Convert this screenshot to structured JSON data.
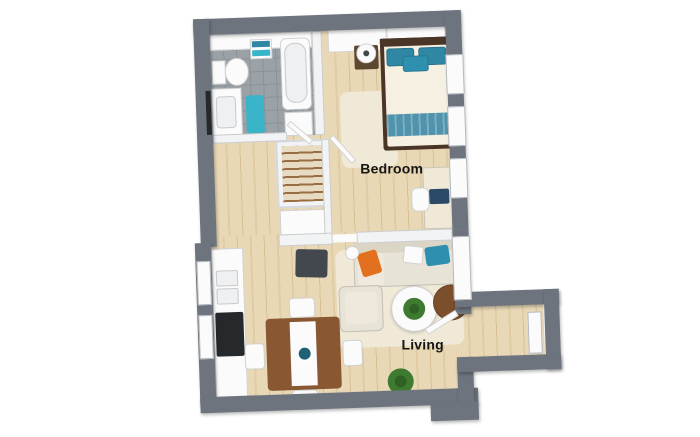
{
  "plan": {
    "labels": {
      "bedroom": "Bedroom",
      "living": "Living"
    },
    "colors": {
      "wall": "#6d747d",
      "innerWall": "#f2f3f4",
      "wood": "#e9d8b6",
      "woodStreak": "#dfcba4",
      "woodDark": "#d6c094",
      "tile": "#9aa2a8",
      "tileLine": "#8b9399",
      "white": "#fbfbfb",
      "cream": "#f0e9d8",
      "sofa": "#e7e3d6",
      "sofaBack": "#dad5c4",
      "sofaSeat": "#eee9dc",
      "teal": "#2f87a3",
      "tealBright": "#3ab4c8",
      "tealSofa": "#2f8fae",
      "tealRunner": "#4f93ac",
      "tealDeep": "#1f6077",
      "orange": "#e2701f",
      "brown": "#8a5733",
      "brownDark": "#7b4e2c",
      "nightstand": "#5e4731",
      "bedFrame": "#4a3527",
      "mattress": "#f5f0e1",
      "charcoal": "#43484e",
      "black": "#26292c",
      "green": "#3e7b30",
      "greenDark": "#2f6124",
      "navy": "#2b4a67",
      "basin": "#eef0f1"
    },
    "defaults": {
      "furnitureBorder": "1px solid rgba(0,0,0,0.16)",
      "windowBorder": "1px solid #b3b9bf",
      "wallShadow": "1px 2px 3px rgba(0,0,0,0.28)"
    }
  },
  "shapes": [
    {
      "n": "floor-bathroom-tile",
      "x": 216,
      "y": 30,
      "w": 102,
      "h": 104,
      "f": "tile"
    },
    {
      "n": "floor-bedroom-wood",
      "x": 328,
      "y": 30,
      "w": 124,
      "h": 202,
      "f": "wood"
    },
    {
      "n": "floor-hallway-wood",
      "x": 216,
      "y": 134,
      "w": 112,
      "h": 98,
      "f": "wood"
    },
    {
      "n": "floor-living-wood",
      "x": 210,
      "y": 232,
      "w": 256,
      "h": 160,
      "f": "wood"
    },
    {
      "n": "floor-vestibule-wood",
      "x": 466,
      "y": 311,
      "w": 74,
      "h": 50,
      "f": "wood"
    },
    {
      "n": "floor-threshold-vestibule",
      "x": 452,
      "y": 317,
      "w": 16,
      "h": 44,
      "f": "wood"
    },
    {
      "n": "bedroom-rug",
      "x": 344,
      "y": 92,
      "w": 56,
      "h": 76,
      "f": "cream",
      "r": 8
    },
    {
      "n": "living-rug",
      "x": 334,
      "y": 250,
      "w": 126,
      "h": 98,
      "f": "cream",
      "r": 8
    },
    {
      "n": "bathroom-wall-tiles",
      "x": 216,
      "y": 30,
      "w": 102,
      "h": 16,
      "f": "white",
      "b": "1px solid #d8dbde"
    },
    {
      "n": "toilet-tank",
      "x": 217,
      "y": 56,
      "w": 14,
      "h": 24,
      "f": "white",
      "b": 1
    },
    {
      "n": "toilet-bowl",
      "x": 230,
      "y": 54,
      "w": 24,
      "h": 28,
      "f": "white",
      "r": "50%",
      "b": 1
    },
    {
      "n": "vanity-counter",
      "x": 216,
      "y": 84,
      "w": 30,
      "h": 50,
      "f": "white",
      "b": 1
    },
    {
      "n": "vanity-basin",
      "x": 220,
      "y": 92,
      "w": 20,
      "h": 32,
      "f": "basin",
      "r": 4,
      "b": 1
    },
    {
      "n": "bathtub",
      "x": 286,
      "y": 36,
      "w": 30,
      "h": 72,
      "f": "white",
      "r": 6,
      "b": 1
    },
    {
      "n": "bathtub-inner",
      "x": 290,
      "y": 41,
      "w": 22,
      "h": 60,
      "f": "basin",
      "r": 10,
      "b": 1
    },
    {
      "n": "towel-shelf",
      "x": 256,
      "y": 36,
      "w": 22,
      "h": 20,
      "f": "white",
      "b": 1
    },
    {
      "n": "towel-teal-top",
      "x": 258,
      "y": 38,
      "w": 18,
      "h": 6,
      "f": "teal"
    },
    {
      "n": "towel-teal-bottom",
      "x": 258,
      "y": 47,
      "w": 18,
      "h": 6,
      "f": "tealBright"
    },
    {
      "n": "bath-mat",
      "x": 250,
      "y": 92,
      "w": 18,
      "h": 38,
      "f": "tealBright",
      "r": 3
    },
    {
      "n": "washer-cabinet",
      "x": 288,
      "y": 110,
      "w": 28,
      "h": 24,
      "f": "white",
      "b": 1
    },
    {
      "n": "wardrobe",
      "x": 334,
      "y": 26,
      "w": 118,
      "h": 26,
      "f": "white",
      "b": 1
    },
    {
      "n": "wardrobe-door-divider",
      "x": 392,
      "y": 27,
      "w": 2,
      "h": 24,
      "f": "#d9dcdf"
    },
    {
      "n": "nightstand",
      "x": 360,
      "y": 46,
      "w": 24,
      "h": 24,
      "f": "nightstand",
      "r": 2
    },
    {
      "n": "nightstand-lamp",
      "x": 362,
      "y": 44,
      "w": 20,
      "h": 20,
      "f": "white",
      "r": "50%",
      "b": 1
    },
    {
      "n": "nightstand-lamp-center",
      "x": 369,
      "y": 51,
      "w": 6,
      "h": 6,
      "f": "charcoal",
      "r": "50%"
    },
    {
      "n": "bed-frame",
      "x": 386,
      "y": 40,
      "w": 72,
      "h": 112,
      "f": "bedFrame",
      "r": 3
    },
    {
      "n": "bed-mattress",
      "x": 390,
      "y": 46,
      "w": 64,
      "h": 102,
      "f": "mattress",
      "r": 2
    },
    {
      "n": "bed-pillow-left",
      "x": 392,
      "y": 50,
      "w": 28,
      "h": 18,
      "f": "teal",
      "r": 3,
      "b": 1
    },
    {
      "n": "bed-pillow-right",
      "x": 424,
      "y": 50,
      "w": 28,
      "h": 18,
      "f": "teal",
      "r": 3,
      "b": 1
    },
    {
      "n": "bed-pillow-accent",
      "x": 408,
      "y": 58,
      "w": 26,
      "h": 16,
      "f": "tealSofa",
      "r": 3,
      "b": 1
    },
    {
      "n": "bed-throw-blanket",
      "x": 390,
      "y": 116,
      "w": 64,
      "h": 22,
      "f": "tealStripe"
    },
    {
      "n": "bed-headboard",
      "x": 386,
      "y": 40,
      "w": 72,
      "h": 8,
      "f": "bedFrame"
    },
    {
      "n": "desk",
      "x": 424,
      "y": 170,
      "w": 32,
      "h": 62,
      "f": "cream",
      "b": 1
    },
    {
      "n": "desk-laptop",
      "x": 430,
      "y": 192,
      "w": 20,
      "h": 15,
      "f": "navy",
      "r": 2
    },
    {
      "n": "desk-chair",
      "x": 412,
      "y": 190,
      "w": 18,
      "h": 24,
      "f": "white",
      "r": 6,
      "b": 1
    },
    {
      "n": "kitchen-counter",
      "x": 210,
      "y": 244,
      "w": 32,
      "h": 150,
      "f": "white",
      "b": 1
    },
    {
      "n": "kitchen-sink-top",
      "x": 214,
      "y": 266,
      "w": 22,
      "h": 16,
      "f": "basin",
      "r": 2,
      "b": 1
    },
    {
      "n": "kitchen-sink-bottom",
      "x": 214,
      "y": 284,
      "w": 22,
      "h": 16,
      "f": "basin",
      "r": 2,
      "b": 1
    },
    {
      "n": "kitchen-cooktop",
      "x": 212,
      "y": 308,
      "w": 28,
      "h": 44,
      "f": "black",
      "r": 2
    },
    {
      "n": "dining-table",
      "x": 262,
      "y": 316,
      "w": 74,
      "h": 72,
      "f": "brown",
      "r": 4
    },
    {
      "n": "dining-table-runner",
      "x": 286,
      "y": 320,
      "w": 26,
      "h": 64,
      "f": "white"
    },
    {
      "n": "dining-bowl",
      "x": 292,
      "y": 344,
      "w": 16,
      "h": 16,
      "f": "tealDeep",
      "r": "50%",
      "b": "2px solid #ffffff"
    },
    {
      "n": "dining-chair-top",
      "x": 286,
      "y": 296,
      "w": 26,
      "h": 20,
      "f": "white",
      "r": 4,
      "b": 1
    },
    {
      "n": "dining-chair-bottom",
      "x": 286,
      "y": 388,
      "w": 26,
      "h": 20,
      "f": "white",
      "r": 4,
      "b": 1
    },
    {
      "n": "dining-chair-left",
      "x": 240,
      "y": 340,
      "w": 20,
      "h": 26,
      "f": "white",
      "r": 4,
      "b": 1
    },
    {
      "n": "dining-chair-right",
      "x": 338,
      "y": 340,
      "w": 20,
      "h": 26,
      "f": "white",
      "r": 4,
      "b": 1
    },
    {
      "n": "sofa",
      "x": 352,
      "y": 242,
      "w": 102,
      "h": 46,
      "f": "sofa",
      "r": 4,
      "b": 1
    },
    {
      "n": "sofa-backrest",
      "x": 352,
      "y": 242,
      "w": 102,
      "h": 12,
      "f": "sofaBack"
    },
    {
      "n": "sofa-chaise",
      "x": 356,
      "y": 254,
      "w": 26,
      "h": 32,
      "f": "sofaSeat",
      "r": 3
    },
    {
      "n": "sofa-pillow-orange",
      "x": 358,
      "y": 252,
      "w": 20,
      "h": 24,
      "f": "orange",
      "r": 3,
      "rot": -15
    },
    {
      "n": "sofa-pillow-white",
      "x": 402,
      "y": 248,
      "w": 20,
      "h": 18,
      "f": "white",
      "r": 3,
      "rot": 8,
      "b": 1
    },
    {
      "n": "sofa-pillow-teal",
      "x": 424,
      "y": 249,
      "w": 24,
      "h": 19,
      "f": "tealSofa",
      "r": 3,
      "rot": -6
    },
    {
      "n": "floor-lamp",
      "x": 344,
      "y": 246,
      "w": 14,
      "h": 14,
      "f": "white",
      "r": "50%",
      "b": 1
    },
    {
      "n": "armchair",
      "x": 336,
      "y": 286,
      "w": 44,
      "h": 46,
      "f": "sofa",
      "r": 6,
      "b": 1
    },
    {
      "n": "armchair-cushion",
      "x": 342,
      "y": 292,
      "w": 32,
      "h": 32,
      "f": "sofaSeat",
      "r": 4
    },
    {
      "n": "coffee-table",
      "x": 388,
      "y": 288,
      "w": 46,
      "h": 46,
      "f": "white",
      "r": "50%",
      "b": 1,
      "sh": "0 1px 3px rgba(0,0,0,0.2)"
    },
    {
      "n": "coffee-table-plant",
      "x": 400,
      "y": 300,
      "w": 22,
      "h": 22,
      "f": "green",
      "r": "50%"
    },
    {
      "n": "coffee-table-plant-core",
      "x": 406,
      "y": 306,
      "w": 10,
      "h": 10,
      "f": "greenDark",
      "r": "50%"
    },
    {
      "n": "side-table",
      "x": 430,
      "y": 288,
      "w": 36,
      "h": 36,
      "f": "brownDark",
      "r": "50%",
      "b": 1
    },
    {
      "n": "floor-plant",
      "x": 382,
      "y": 370,
      "w": 26,
      "h": 26,
      "f": "green",
      "r": "50%"
    },
    {
      "n": "floor-plant-core",
      "x": 389,
      "y": 377,
      "w": 12,
      "h": 12,
      "f": "greenDark",
      "r": "50%"
    },
    {
      "n": "ottoman-stool",
      "x": 294,
      "y": 248,
      "w": 32,
      "h": 28,
      "f": "charcoal",
      "r": 3,
      "rot": 3
    },
    {
      "n": "closet-frame",
      "x": 278,
      "y": 138,
      "w": 52,
      "h": 68,
      "f": "innerWall",
      "b": "2px solid #d5d8db"
    },
    {
      "n": "closet-hanging-rods",
      "x": 284,
      "y": 144,
      "w": 40,
      "h": 56,
      "f": "rods"
    },
    {
      "n": "hall-cabinet",
      "x": 280,
      "y": 208,
      "w": 46,
      "h": 28,
      "f": "white",
      "b": 1
    },
    {
      "n": "partition-closet-right",
      "x": 324,
      "y": 138,
      "w": 8,
      "h": 96,
      "f": "innerWall",
      "b": 1
    },
    {
      "n": "partition-bath-right",
      "x": 318,
      "y": 30,
      "w": 10,
      "h": 104,
      "f": "innerWall",
      "b": 1
    },
    {
      "n": "wall-bathroom-bottom",
      "x": 216,
      "y": 130,
      "w": 74,
      "h": 9,
      "f": "innerWall",
      "b": 1
    },
    {
      "n": "wall-bedroom-living-left",
      "x": 278,
      "y": 232,
      "w": 54,
      "h": 12,
      "f": "innerWall",
      "b": 1
    },
    {
      "n": "wall-bedroom-living-right",
      "x": 356,
      "y": 232,
      "w": 96,
      "h": 12,
      "f": "innerWall",
      "b": 1
    },
    {
      "n": "threshold-bedroom-living",
      "x": 332,
      "y": 234,
      "w": 24,
      "h": 8,
      "f": "white"
    },
    {
      "n": "wall-top",
      "x": 200,
      "y": 14,
      "w": 266,
      "h": 16,
      "f": "wall",
      "sh": 1
    },
    {
      "n": "wall-left-upper",
      "x": 200,
      "y": 14,
      "w": 16,
      "h": 228,
      "f": "wall",
      "sh": 1
    },
    {
      "n": "wall-left-lower",
      "x": 194,
      "y": 238,
      "w": 16,
      "h": 162,
      "f": "wall",
      "sh": 1
    },
    {
      "n": "wall-bottom",
      "x": 194,
      "y": 392,
      "w": 278,
      "h": 16,
      "f": "wall",
      "sh": 1
    },
    {
      "n": "wall-right-bedroom",
      "x": 452,
      "y": 14,
      "w": 16,
      "h": 218,
      "f": "wall",
      "sh": 1
    },
    {
      "n": "wall-right-living",
      "x": 452,
      "y": 232,
      "w": 16,
      "h": 86,
      "f": "wall",
      "sh": 1
    },
    {
      "n": "wall-connector-right",
      "x": 452,
      "y": 361,
      "w": 16,
      "h": 47,
      "f": "wall",
      "sh": 1
    },
    {
      "n": "vestibule-wall-top",
      "x": 452,
      "y": 296,
      "w": 104,
      "h": 15,
      "f": "wall",
      "sh": 1
    },
    {
      "n": "vestibule-wall-right",
      "x": 541,
      "y": 296,
      "w": 15,
      "h": 80,
      "f": "wall",
      "sh": 1
    },
    {
      "n": "vestibule-wall-bottom",
      "x": 452,
      "y": 361,
      "w": 104,
      "h": 15,
      "f": "wall",
      "sh": 1
    },
    {
      "n": "wall-step-block",
      "x": 424,
      "y": 406,
      "w": 48,
      "h": 18,
      "f": "wall",
      "sh": 1
    },
    {
      "n": "window-right-1",
      "x": 451,
      "y": 58,
      "w": 18,
      "h": 40,
      "f": "white",
      "b": 2
    },
    {
      "n": "window-right-2",
      "x": 451,
      "y": 110,
      "w": 18,
      "h": 40,
      "f": "white",
      "b": 2
    },
    {
      "n": "window-right-3",
      "x": 451,
      "y": 162,
      "w": 18,
      "h": 40,
      "f": "white",
      "b": 2
    },
    {
      "n": "window-right-living",
      "x": 451,
      "y": 240,
      "w": 18,
      "h": 64,
      "f": "white",
      "b": 2
    },
    {
      "n": "window-left-1",
      "x": 195,
      "y": 256,
      "w": 14,
      "h": 44,
      "f": "white",
      "b": 2
    },
    {
      "n": "window-left-2",
      "x": 195,
      "y": 310,
      "w": 14,
      "h": 44,
      "f": "white",
      "b": 2
    },
    {
      "n": "vanity-mirror",
      "x": 210,
      "y": 86,
      "w": 5,
      "h": 44,
      "f": "black"
    },
    {
      "n": "door-bathroom",
      "x": 288,
      "y": 128,
      "w": 30,
      "h": 6,
      "f": "white",
      "b": 1,
      "rot": 42
    },
    {
      "n": "door-bedroom",
      "x": 328,
      "y": 146,
      "w": 34,
      "h": 6,
      "f": "white",
      "b": 1,
      "rot": 50
    },
    {
      "n": "door-living-vestibule",
      "x": 420,
      "y": 322,
      "w": 36,
      "h": 7,
      "f": "white",
      "b": 1,
      "rot": -30
    },
    {
      "n": "front-door",
      "x": 524,
      "y": 318,
      "w": 14,
      "h": 42,
      "f": "white",
      "b": 2
    }
  ]
}
